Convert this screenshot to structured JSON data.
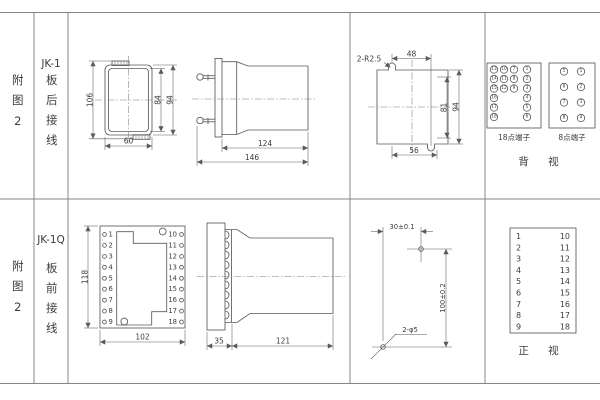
{
  "colors": {
    "line": "#5a5a5a",
    "grid": "#858585",
    "text": "#3c3c3c",
    "background": "#ffffff"
  },
  "row1": {
    "fig": "附图2",
    "model": "JK-1",
    "wiring": "板后接线",
    "front": {
      "h_total": "106",
      "h_inner": "84",
      "h_outer": "94",
      "w_bottom": "60"
    },
    "side": {
      "len_body": "124",
      "len_total": "146"
    },
    "cutout": {
      "note": "2-R2.5",
      "w_top": "48",
      "h_inner": "81",
      "h_outer": "94",
      "w_bottom": "56"
    },
    "t18": {
      "label": "18点端子",
      "rows": [
        [
          "13",
          "10",
          "7",
          "1"
        ],
        [
          "14",
          "11",
          "8",
          "2"
        ],
        [
          "15",
          "12",
          "9",
          "3"
        ],
        [
          "16",
          "4"
        ],
        [
          "17",
          "5"
        ],
        [
          "18",
          "6"
        ]
      ]
    },
    "t8": {
      "label": "8点端子",
      "rows": [
        [
          "5",
          "1"
        ],
        [
          "6",
          "2"
        ],
        [
          "7",
          "3"
        ],
        [
          "8",
          "4"
        ]
      ]
    },
    "view": "背 视"
  },
  "row2": {
    "fig": "附图2",
    "model": "JK-1Q",
    "wiring": "板前接线",
    "panel": {
      "h_left": "118",
      "w_bottom": "102",
      "left": [
        "1",
        "2",
        "3",
        "4",
        "5",
        "6",
        "7",
        "8",
        "9"
      ],
      "right": [
        "10",
        "11",
        "12",
        "13",
        "14",
        "15",
        "16",
        "17",
        "18"
      ]
    },
    "side": {
      "w_flange": "35",
      "len_body": "121"
    },
    "drill": {
      "dx": "30±0.1",
      "dy": "100±0.2",
      "hole": "2-φ5"
    },
    "table": {
      "left": [
        "1",
        "2",
        "3",
        "4",
        "5",
        "6",
        "7",
        "8",
        "9"
      ],
      "right": [
        "10",
        "11",
        "12",
        "13",
        "14",
        "15",
        "16",
        "17",
        "18"
      ]
    },
    "view": "正 视"
  }
}
